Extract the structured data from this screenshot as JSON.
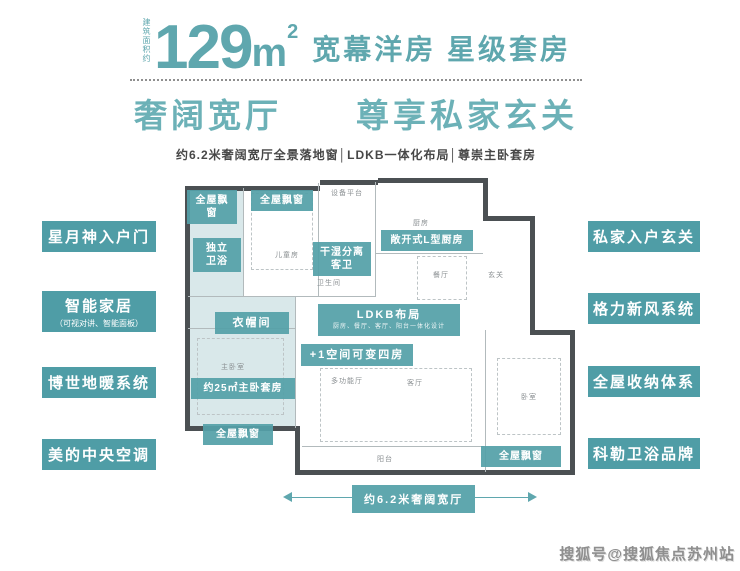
{
  "header": {
    "area_prefix": "建筑面积约",
    "area_value": "129",
    "area_unit": "m",
    "area_sup": "2",
    "tagline": "宽幕洋房 星级套房",
    "headline": "奢阔宽厅　　尊享私家玄关",
    "features_line": "约6.2米奢阔宽厅全景落地窗│LDKB一体化布局│尊崇主卧套房"
  },
  "left_features": [
    {
      "label": "星月神入户门"
    },
    {
      "label": "智能家居",
      "sub": "（可视对讲、智能面板）"
    },
    {
      "label": "博世地暖系统"
    },
    {
      "label": "美的中央空调"
    }
  ],
  "right_features": [
    {
      "label": "私家入户玄关"
    },
    {
      "label": "格力新风系统"
    },
    {
      "label": "全屋收纳体系"
    },
    {
      "label": "科勒卫浴品牌"
    }
  ],
  "floorplan": {
    "labels": {
      "bay_window": "全屋飘窗",
      "independent_bath_1": "独立",
      "independent_bath_2": "卫浴",
      "dry_wet_1": "干湿分离",
      "dry_wet_2": "客卫",
      "open_kitchen": "敞开式L型厨房",
      "ldkb_title": "LDKB布局",
      "ldkb_sub": "厨房、餐厅、客厅、阳台一体化设计",
      "plus_one": "+1空间可变四房",
      "cloakroom": "衣帽间",
      "master_suite": "约25㎡主卧套房"
    },
    "rooms": {
      "equipment": "设备平台",
      "kitchen": "厨房",
      "children": "儿童房",
      "bath": "卫生间",
      "dining": "餐厅",
      "foyer": "玄关",
      "master": "主卧室",
      "multi": "多功能厅",
      "living": "客厅",
      "bedroom": "卧室",
      "balcony": "阳台"
    }
  },
  "dimension": {
    "label": "约6.2米奢阔宽厅"
  },
  "watermark": "搜狐号@搜狐焦点苏州站",
  "colors": {
    "accent": "#4f9da6",
    "accent_light": "#6cb1b7",
    "plan_fill": "#d9e8ea",
    "wall": "#4b5053",
    "text_dark": "#474747",
    "watermark_gray": "#8f8f8f"
  }
}
